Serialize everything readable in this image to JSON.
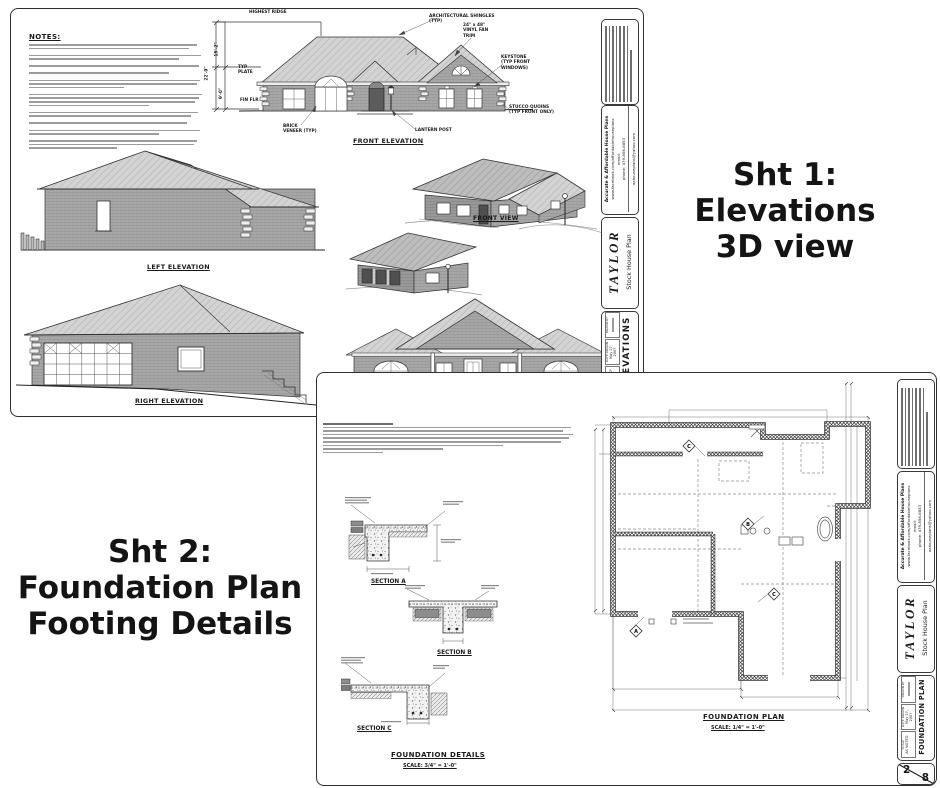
{
  "colors": {
    "line": "#2e2e2e",
    "roof_fill": "#d3d3d3",
    "wall_fill": "#a7a7a7",
    "text": "#141414",
    "skeleton": "#9c9c9c"
  },
  "overlay": {
    "sheet1": [
      "Sht 1:",
      "Elevations",
      "3D view"
    ],
    "sheet2": [
      "Sht 2:",
      "Foundation Plan",
      "Footing Details"
    ]
  },
  "sheet1": {
    "notes_heading": "NOTES:",
    "views": {
      "front": "FRONT ELEVATION",
      "front3d": "FRONT VIEW",
      "left": "LEFT ELEVATION",
      "right": "RIGHT ELEVATION",
      "rear": "REAR ELEVATION"
    },
    "callouts": {
      "highest_ridge": "HIGHEST RIDGE",
      "shingles1": "ARCHITECTURAL SHINGLES",
      "shingles2": "(TYP)",
      "fan1": "24\" x 48\"",
      "fan2": "VINYL FAN",
      "fan3": "TRIM",
      "key1": "KEYSTONE",
      "key2": "(TYP FRONT",
      "key3": "WINDOWS)",
      "quoin1": "STUCCO QUOINS",
      "quoin2": "(TYP FRONT ONLY)",
      "brick1": "BRICK",
      "brick2": "VENEER (TYP)",
      "lantern": "LANTERN POST",
      "plate1": "TYP",
      "plate2": "PLATE",
      "finflr": "FIN FLR",
      "dim_upper": "15'-2\"",
      "dim_total": "22'-9\"",
      "dim_lower": "9'-0\""
    },
    "titleblock": {
      "panel": "ELEVATIONS",
      "scale": "1/4\" = 1'-0\"",
      "sheet_no": "1",
      "sheet_total": "8"
    }
  },
  "sheet2": {
    "sections": {
      "a": "SECTION A",
      "b": "SECTION B",
      "c": "SECTION C"
    },
    "details_title": "FOUNDATION DETAILS",
    "details_scale": "SCALE: 3/4\" = 1'-0\"",
    "plan_title": "FOUNDATION PLAN",
    "plan_scale": "SCALE: 1/4\" = 1'-0\"",
    "markers": {
      "a": "A",
      "b": "B",
      "c": "C"
    },
    "titleblock": {
      "panel": "FOUNDATION PLAN",
      "scale": "AS NOTED",
      "sheet_no": "2",
      "sheet_total": "8"
    }
  },
  "titleblock": {
    "company": "Accurate & Affordable House Plans",
    "website": "www.facebook.com/affordablehouseplans",
    "email_label": "email:",
    "phone": "phone: 479-856-6853",
    "email": "aahouseplans@yahoo.com",
    "brand": "TAYLOR",
    "plan_name": "Stock House Plan",
    "field_scale": "SCALE",
    "field_date": "DATE DRAWN",
    "field_drawn": "DRAWN BY",
    "date": "May 27, 2007"
  }
}
